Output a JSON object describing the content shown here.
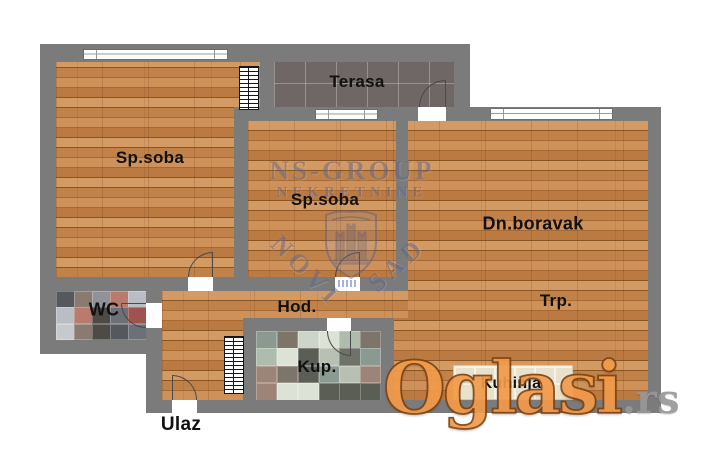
{
  "rooms": {
    "bedroom1": "Sp.soba",
    "terrace": "Terasa",
    "bedroom2": "Sp.soba",
    "living": "Dn.boravak",
    "dining": "Trp.",
    "wc": "WC",
    "hallway": "Hod.",
    "bathroom": "Kup.",
    "kitchen": "Kuhinja",
    "entrance": "Ulaz"
  },
  "watermark": {
    "agency_line1": "NS-GROUP",
    "agency_line2": "NEKRETNINE",
    "city_word1": "NOVI",
    "city_word2": "SAD"
  },
  "brand": {
    "name": "Oglasi",
    "tld": ".rs"
  },
  "colors": {
    "wall": "#7b7b7b",
    "outside": "#ffffff",
    "wood_mid": "#c08249",
    "wood_light": "#d49a63",
    "wood_dark": "#a76a34",
    "wood_joint": "#8a5522",
    "terrace_tile": "#6e6765",
    "terrace_grout": "#918a88",
    "kitchen_tile": "#e8e1cc",
    "kitchen_grout": "#f7f2e4",
    "label_text": "#111111",
    "watermark": "#5f678c",
    "logo_orange": "#f29a4a",
    "logo_outline": "#7d4413",
    "logo_tld": "#97989a",
    "door_line": "#4a4a4a",
    "wc_tiles": [
      "#b9bec4",
      "#8f9399",
      "#55585c",
      "#4e4a46",
      "#a0524e",
      "#b97b6b",
      "#8a7a70",
      "#c7cacd",
      "#6d7076"
    ],
    "bath_tiles": [
      "#aebcae",
      "#ccd5c8",
      "#8a9a90",
      "#5b5e55",
      "#6f7268",
      "#dde2d6",
      "#7d756a",
      "#9c8578",
      "#b7c0b2"
    ]
  }
}
